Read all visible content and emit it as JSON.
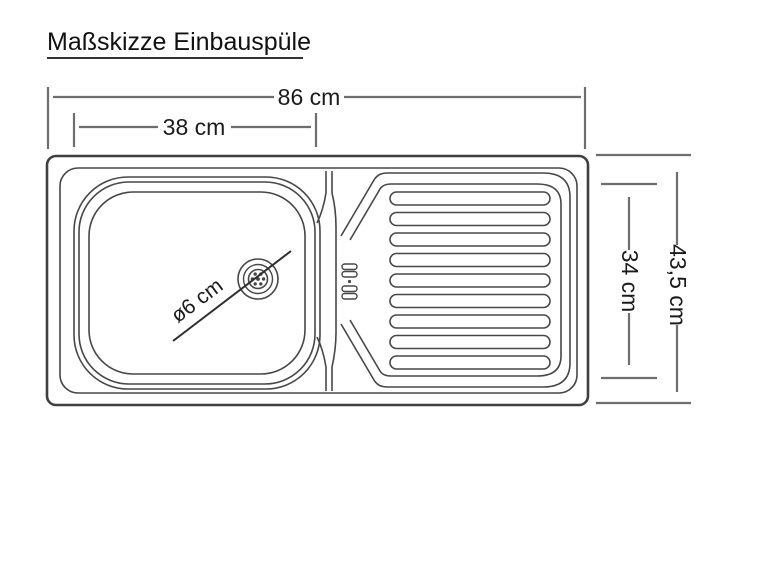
{
  "title": "Maßskizze Einbauspüle",
  "sketch": {
    "subject": "Einbauspüle top view dimension sketch",
    "dimensions": {
      "overall_width": "86 cm",
      "basin_width": "38 cm",
      "overall_depth": "43,5 cm",
      "inner_depth": "34 cm",
      "drain_diameter": "ø6 cm"
    },
    "colors": {
      "drawing_line": "#474747",
      "dimension_line": "#6e6e6e",
      "text": "#141414",
      "background": "#ffffff"
    }
  }
}
